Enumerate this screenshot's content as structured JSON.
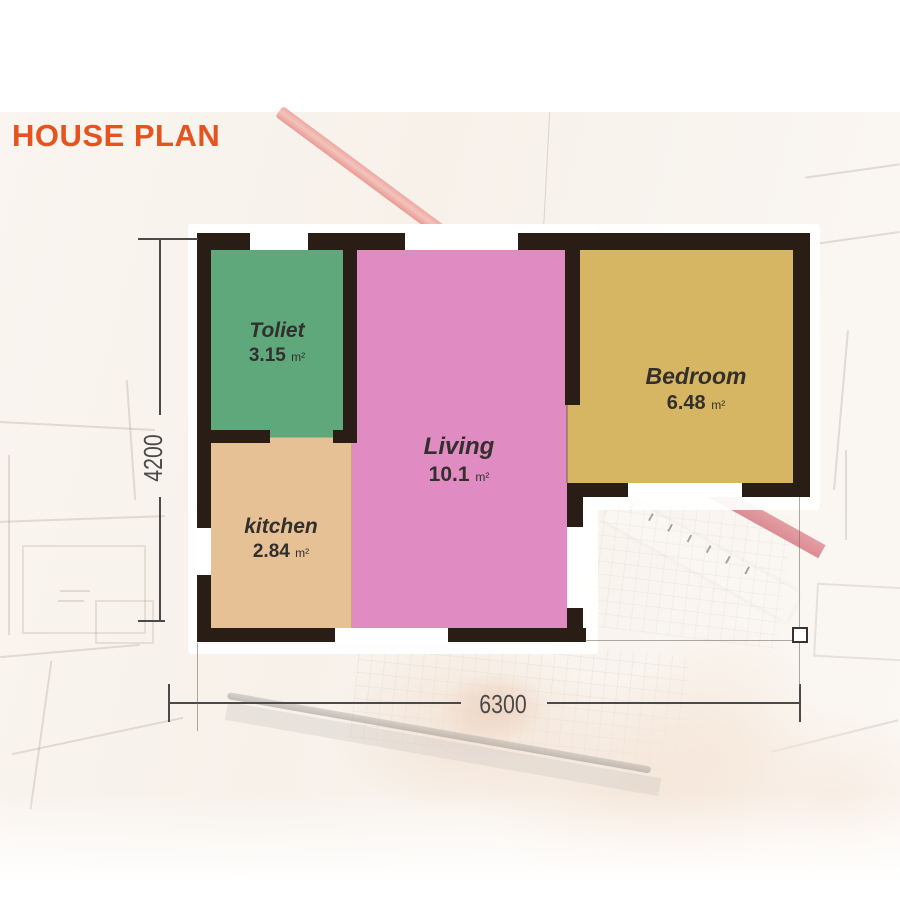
{
  "title": "HOUSE PLAN",
  "plan": {
    "rooms": [
      {
        "id": "toliet",
        "name": "Toliet",
        "area": "3.15",
        "unit": "m²",
        "color": "#5ea87c"
      },
      {
        "id": "kitchen",
        "name": "kitchen",
        "area": "2.84",
        "unit": "m²",
        "color": "#e7c196"
      },
      {
        "id": "living",
        "name": "Living",
        "area": "10.1",
        "unit": "m²",
        "color": "#e08cc2"
      },
      {
        "id": "bedroom",
        "name": "Bedroom",
        "area": "6.48",
        "unit": "m²",
        "color": "#d6b663"
      }
    ],
    "dimensions": {
      "width_mm": "6300",
      "height_mm": "4200"
    },
    "wall_color": "#2a1d15",
    "title_color": "#e5531f",
    "accent_ruler_color": "#e89a93"
  }
}
